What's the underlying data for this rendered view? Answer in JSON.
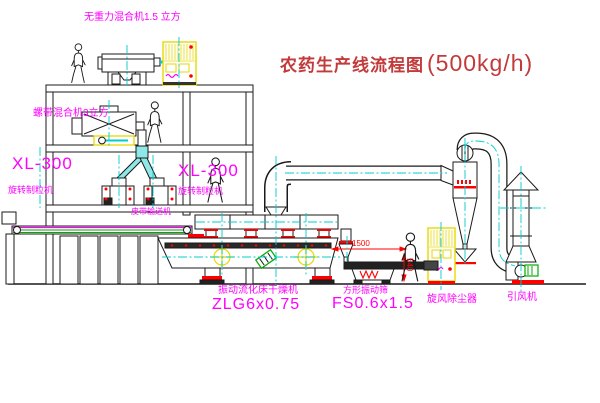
{
  "title": {
    "text": "农药生产线流程图",
    "capacity": "(500kg/h)"
  },
  "equipment_labels": {
    "mixer_top": "无重力混合机1.5 立方",
    "mixer_mid": "螺带混合机3立方",
    "granulator_left_model": "XL-300",
    "granulator_left_name": "旋转制粒机",
    "granulator_mid_model": "XL-300",
    "granulator_mid_name": "旋转制粒机",
    "belt_conveyor": "皮带输送机",
    "dryer_name": "振动流化床干燥机",
    "dryer_model": "ZLG6x0.75",
    "sieve_name": "方形振动筛",
    "sieve_model": "FS0.6x1.5",
    "cyclone": "旋风除尘器",
    "fan": "引风机"
  },
  "dimensions": {
    "sieve_length": "1500",
    "sieve_height": "540"
  },
  "colors": {
    "label_magenta": "#FF00FF",
    "title_red": "#C23A3A",
    "dimension_red": "#FF0000",
    "line_black": "#1A1A1A",
    "centerline_cyan": "#00CCCC",
    "equipment_yellow": "#E6D800",
    "motor_green": "#00AA00"
  }
}
